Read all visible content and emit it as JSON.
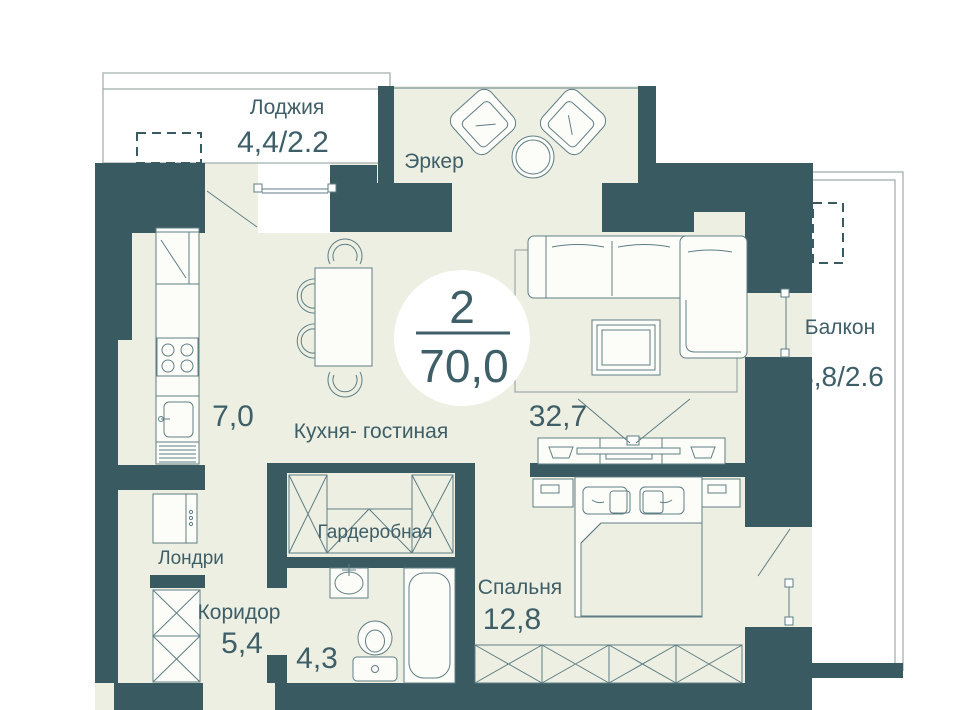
{
  "badge": {
    "rooms": "2",
    "area": "70,0"
  },
  "rooms": {
    "loggia": {
      "label": "Лоджия",
      "area": "4,4/2.2"
    },
    "bay": {
      "label": "Эркер"
    },
    "kitchen_living": {
      "label": "Кухня- гостиная",
      "kitchen_area": "7,0",
      "living_area": "32,7"
    },
    "balcony": {
      "label": "Балкон",
      "area": "8,8/2.6"
    },
    "wardrobe_room": {
      "label": "Гардеробная"
    },
    "laundry": {
      "label": "Лондри"
    },
    "corridor": {
      "label": "Коридор",
      "area": "5,4"
    },
    "bathroom": {
      "area": "4,3"
    },
    "bedroom": {
      "label": "Спальня",
      "area": "12,8"
    }
  },
  "colors": {
    "wall": "#3a5a61",
    "floor": "#ecefe1",
    "text": "#3e5e68",
    "furniture_line": "#5f7d85",
    "outline": "#9fabaa",
    "badge_bg": "#ffffff"
  }
}
